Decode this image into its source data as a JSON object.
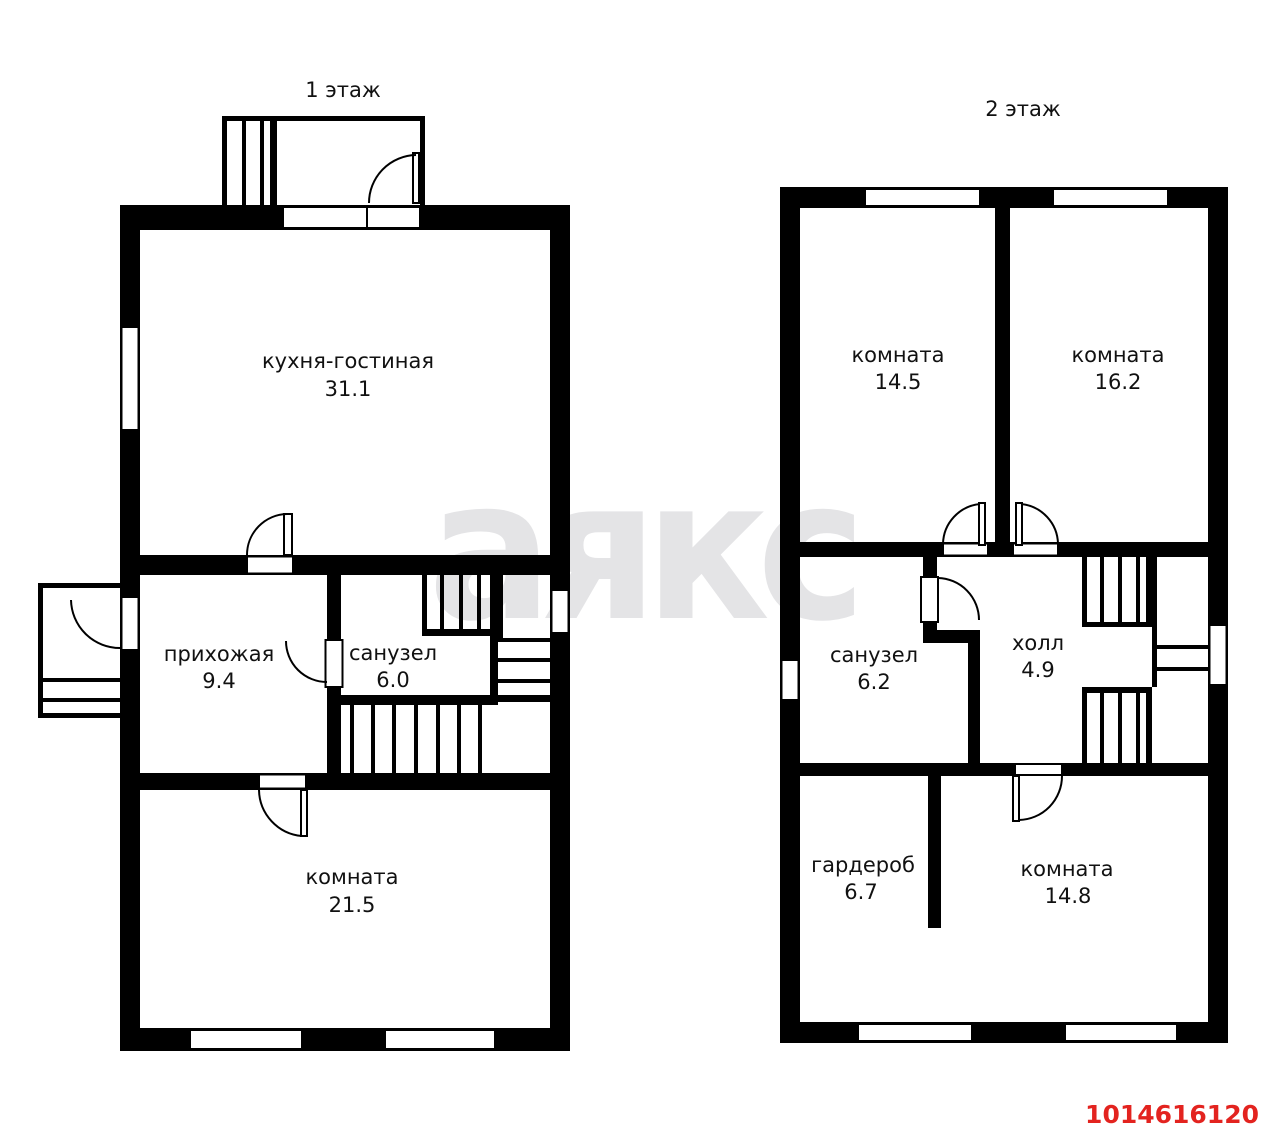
{
  "floor1": {
    "title": "1 этаж",
    "rooms": [
      {
        "name": "кухня-гостиная",
        "area": "31.1"
      },
      {
        "name": "прихожая",
        "area": "9.4"
      },
      {
        "name": "санузел",
        "area": "6.0"
      },
      {
        "name": "комната",
        "area": "21.5"
      }
    ]
  },
  "floor2": {
    "title": "2 этаж",
    "rooms": [
      {
        "name": "комната",
        "area": "14.5"
      },
      {
        "name": "комната",
        "area": "16.2"
      },
      {
        "name": "санузел",
        "area": "6.2"
      },
      {
        "name": "холл",
        "area": "4.9"
      },
      {
        "name": "гардероб",
        "area": "6.7"
      },
      {
        "name": "комната",
        "area": "14.8"
      }
    ]
  },
  "watermark": {
    "text": "аякс",
    "color": "#e4e4e6"
  },
  "listing": {
    "id": "1014616120",
    "color": "#e3231f"
  },
  "colors": {
    "wall": "#000000",
    "background": "#ffffff"
  }
}
